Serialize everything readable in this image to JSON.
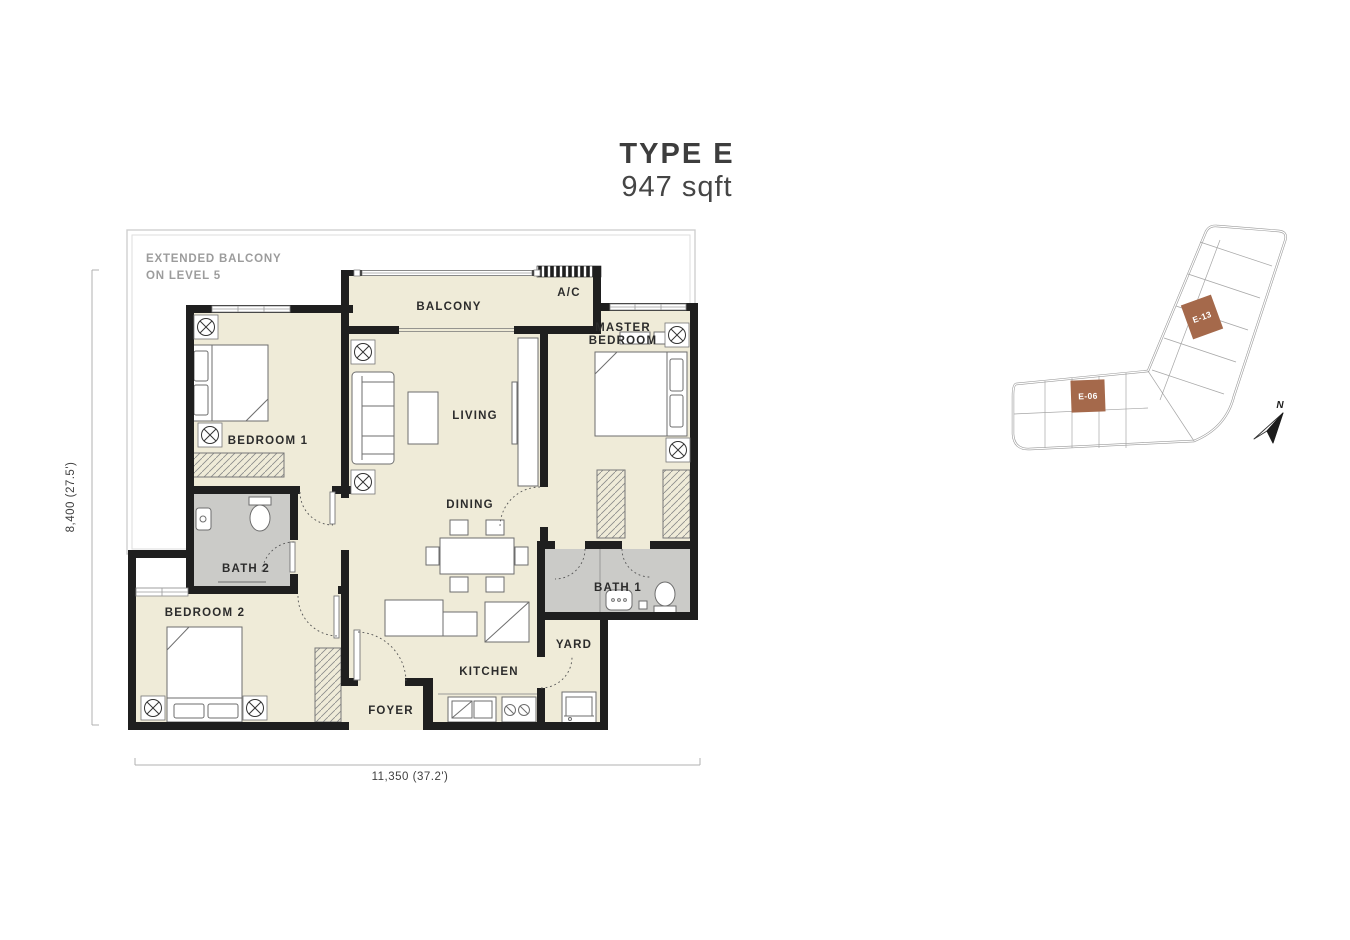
{
  "title": {
    "type_label": "TYPE E",
    "area_label": "947 sqft"
  },
  "plan": {
    "note_line1": "EXTENDED BALCONY",
    "note_line2": "ON LEVEL 5",
    "rooms": {
      "balcony": "BALCONY",
      "ac": "A/C",
      "master_line1": "MASTER",
      "master_line2": "BEDROOM",
      "bedroom1": "BEDROOM 1",
      "living": "LIVING",
      "dining": "DINING",
      "bath2": "BATH 2",
      "bedroom2": "BEDROOM 2",
      "bath1": "BATH 1",
      "yard": "YARD",
      "kitchen": "KITCHEN",
      "foyer": "FOYER"
    },
    "dimensions": {
      "height_label": "8,400 (27.5')",
      "width_label": "11,350 (37.2')"
    }
  },
  "key_plan": {
    "unit_upper": "E-13",
    "unit_lower": "E-06",
    "north_label": "N",
    "highlight_color": "#A5694B"
  },
  "colors": {
    "room_fill": "#EFEBD8",
    "bath_fill": "#CBCBC8",
    "wall": "#1F1F1F",
    "outline_gray": "#CFCFCF",
    "label": "#2C2C2C",
    "note_gray": "#9C9C9C"
  }
}
